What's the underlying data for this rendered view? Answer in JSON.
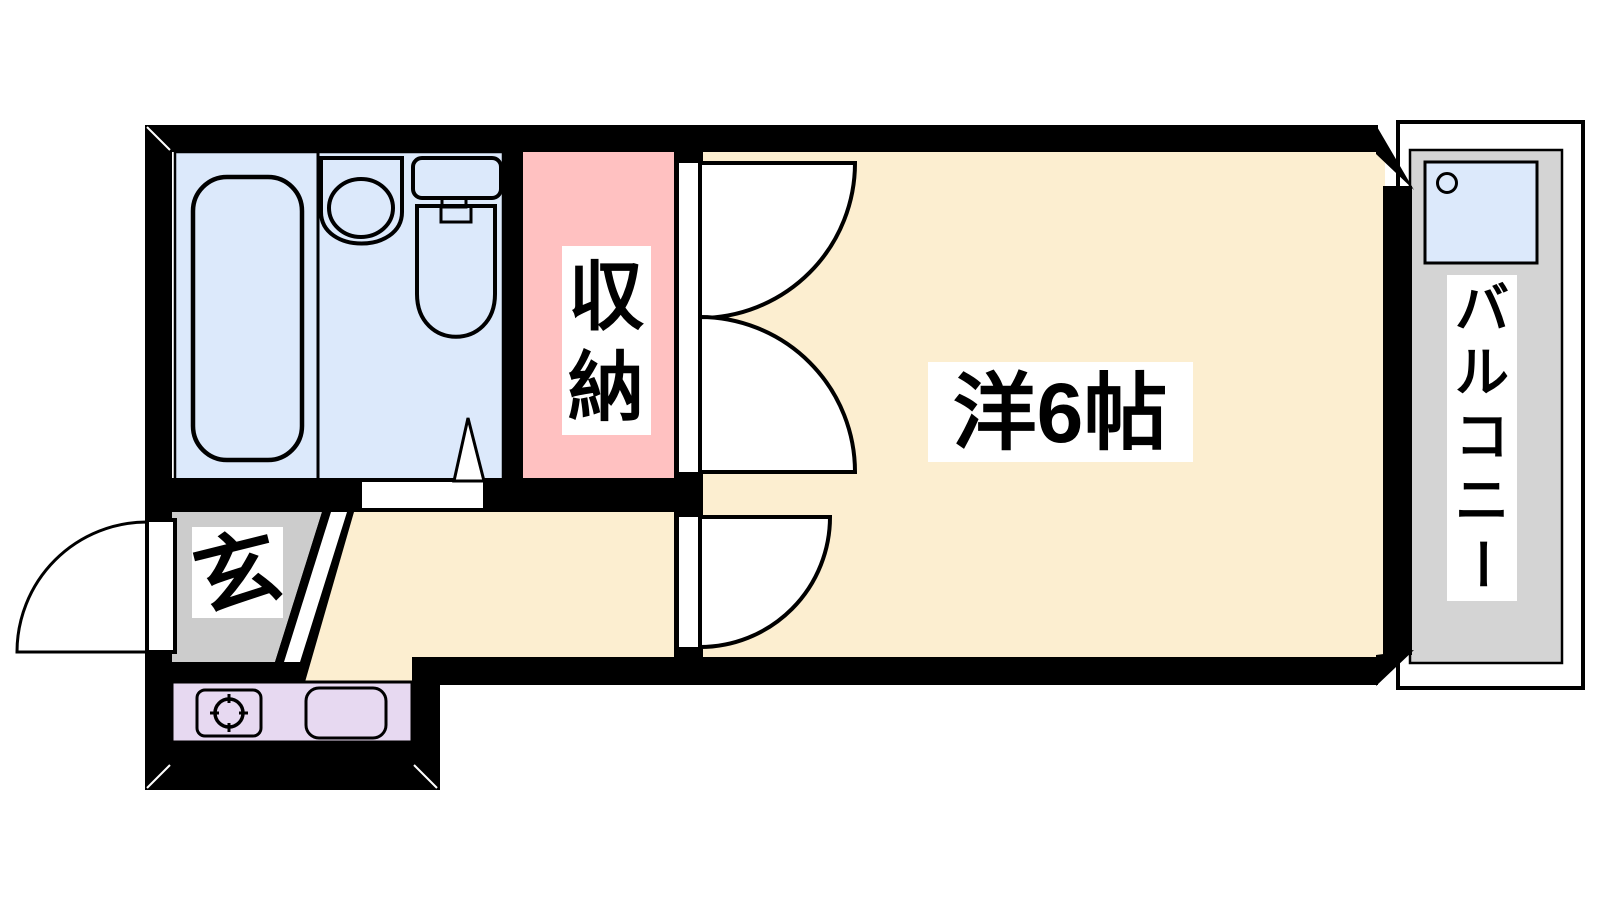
{
  "plan": {
    "type": "apartment-floor-plan",
    "labels": {
      "main_room": "洋6帖",
      "closet": "収納",
      "balcony": "バルコニー",
      "entrance": "玄"
    },
    "colors": {
      "wall": "#000000",
      "main_room_floor": "#FCEED0",
      "closet_floor": "#FFC1C1",
      "bathroom_floor": "#DCE9FB",
      "entrance_floor": "#CCCCCC",
      "kitchen_counter": "#E7D9F1",
      "balcony_floor": "#D4D4D4",
      "washer_pan": "#DCE9FB",
      "label_background": "#FFFFFF",
      "line": "#000000"
    }
  }
}
